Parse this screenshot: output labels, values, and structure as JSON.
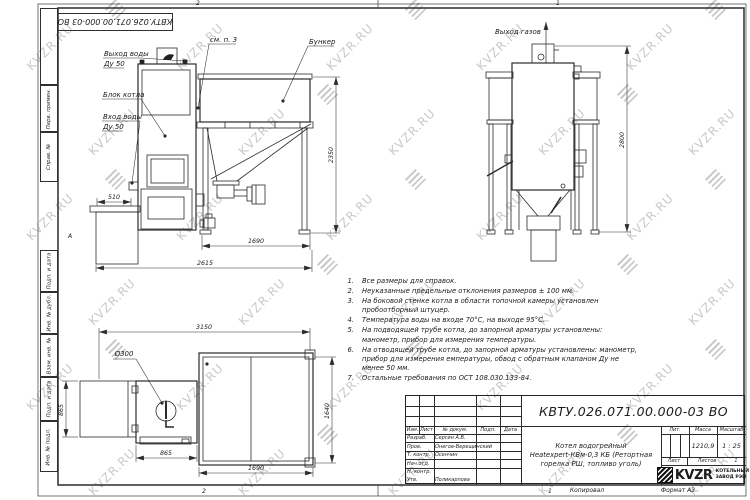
{
  "frame": {
    "zone_top_left": "2",
    "zone_top_right": "1",
    "zone_bottom_left": "2",
    "zone_bottom_right": "1",
    "zone_letter": "А",
    "copied": "Копировал",
    "format": "Формат А3"
  },
  "margin_labels": [
    "Перв. примен.",
    "Справ. №",
    "Подп. и дата",
    "Инв. № дубл.",
    "Взам. инв. №",
    "Подп. и дата",
    "Инв. № подл."
  ],
  "views": {
    "front": {
      "labels": {
        "water_out1": "Выход воды",
        "water_out2": "Ду 50",
        "boiler_block": "Блок котла",
        "water_in1": "Вход воды",
        "water_in2": "Ду 50",
        "see_note": "см. п. 3",
        "bunker": "Бункер"
      },
      "dims": {
        "d510": "510",
        "d2350": "2350",
        "d1690": "1690",
        "d2615": "2615"
      }
    },
    "side": {
      "labels": {
        "gas_out": "Выход газов"
      },
      "dims": {
        "d2800": "2800"
      }
    },
    "plan": {
      "labels": {
        "diameter": "Ø300"
      },
      "dims": {
        "d3150": "3150",
        "d865_left": "865",
        "d865_bottom": "865",
        "d1640": "1640",
        "d1690": "1690"
      }
    }
  },
  "notes": [
    {
      "num": "1.",
      "text": "Все размеры для справок."
    },
    {
      "num": "2.",
      "text": "Неуказанные предельные отклонения размеров ± 100 мм."
    },
    {
      "num": "3.",
      "text": "На боковой стенке котла в области топочной камеры установлен пробоотборный штуцер."
    },
    {
      "num": "4.",
      "text": "Температура воды на входе 70°С, на выходе 95°С."
    },
    {
      "num": "5.",
      "text": "На подводящей трубе котла, до запорной арматуры установлены: манометр, прибор для измерения температуры."
    },
    {
      "num": "6.",
      "text": "На отводящей трубе котла, до запорной арматуры установлены: манометр, прибор для измерения емпературы, обвод с обратным клапаном Ду не менее 50 мм."
    },
    {
      "num": "7.",
      "text": "Остальные требования по ОСТ 108.030.133-84."
    }
  ],
  "title_block": {
    "doc_number": "КВТУ.026.071.00.000-03 ВО",
    "product_line1": "Котел водогрейный",
    "product_line2": "Heatexpert-КВм-0,3 КБ (Ретортная",
    "product_line3": "горелка РШ, топливо уголь)",
    "cols": {
      "izm": "Изм.",
      "list": "Лист",
      "doc": "№ докум.",
      "podp": "Подп.",
      "data": "Дата"
    },
    "rows": [
      {
        "role": "Разраб.",
        "name": "Сергин А.В."
      },
      {
        "role": "Пров.",
        "name": "Онегов-Верещинский"
      },
      {
        "role": "Т. контр.",
        "name": "Осенчин"
      },
      {
        "role": "Нач.отд.",
        "name": ""
      },
      {
        "role": "Н. контр.",
        "name": ""
      },
      {
        "role": "Утв.",
        "name": "Поликарпова"
      }
    ],
    "lit_label": "Лит.",
    "mass_label": "Масса",
    "scale_label": "Масштаб",
    "mass_value": "1210,9",
    "scale_value": "1 : 25",
    "sheet_label": "Лист",
    "sheets_label": "Листов",
    "sheets_value": "1",
    "logo_text": "KVZR",
    "org_line1": "КОТЕЛЬНЫЙ",
    "org_line2": "ЗАВОД РЭП"
  },
  "watermark": {
    "text": "KVZR.RU"
  }
}
